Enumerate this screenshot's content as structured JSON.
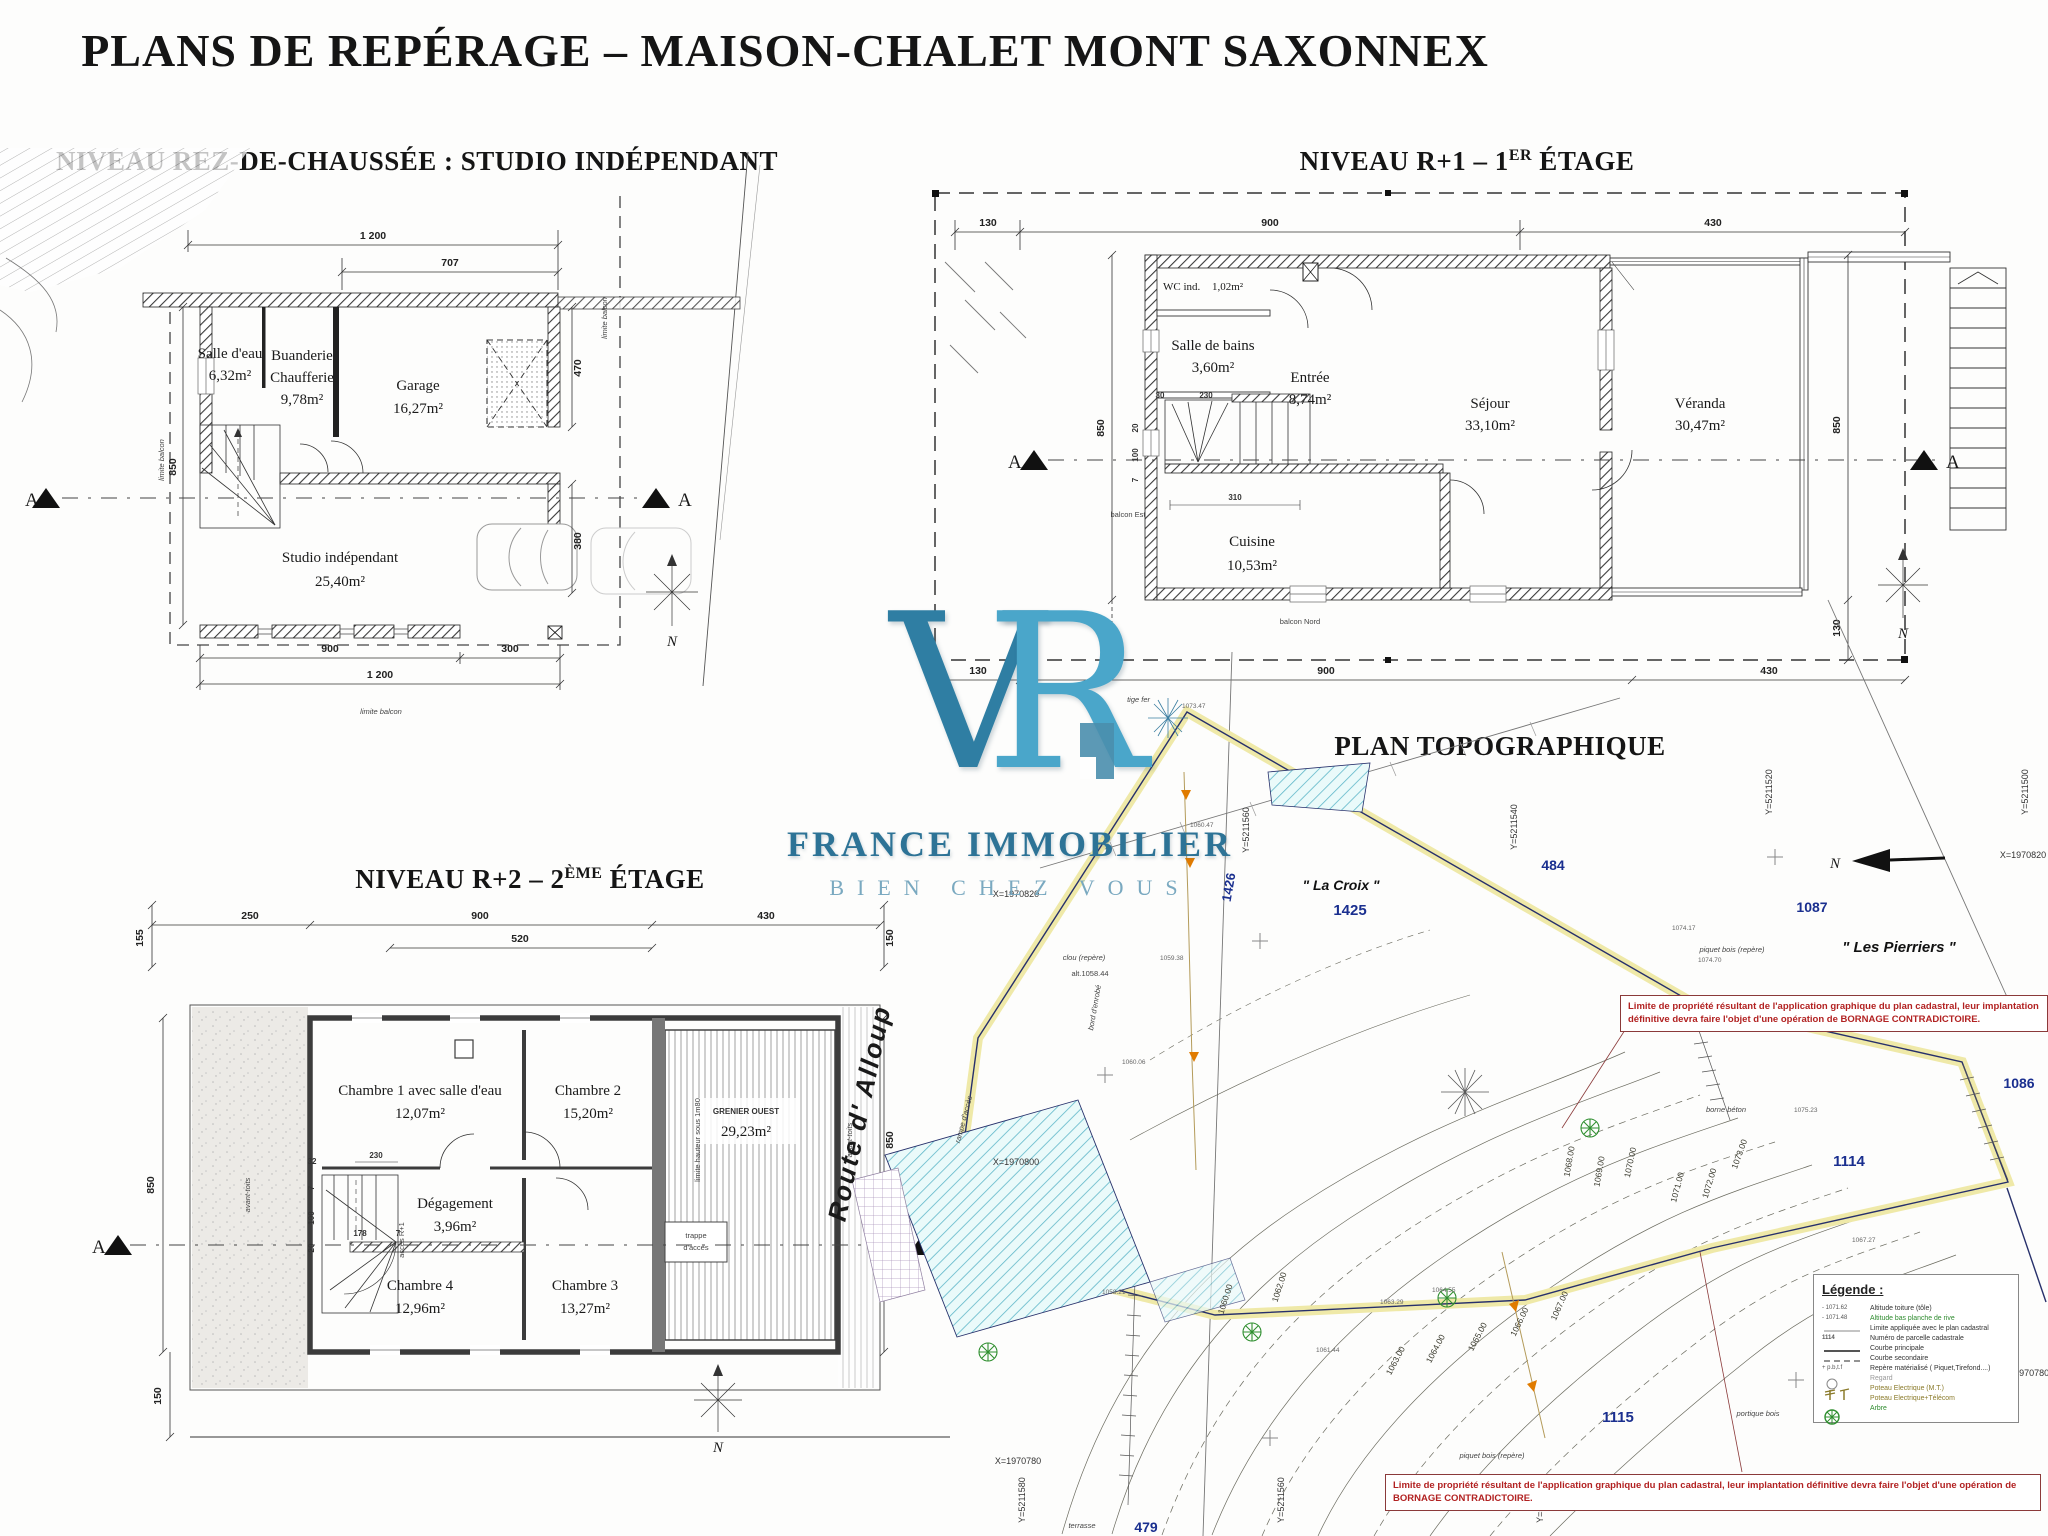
{
  "title": "PLANS DE REPÉRAGE – MAISON-CHALET MONT SAXONNEX",
  "logo": {
    "letter_v": "V",
    "letter_r": "R",
    "name": "FRANCE IMMOBILIER",
    "tagline": "BIEN CHEZ VOUS",
    "color_dark": "#2f7ea3",
    "color_light": "#4aa6ca"
  },
  "compass_label": "N",
  "section_label": "A",
  "plans": {
    "rdc": {
      "title": "NIVEAU REZ-DE-CHAUSSÉE : STUDIO INDÉPENDANT",
      "rooms": [
        {
          "name": "Salle d'eau",
          "area": "6,32m²"
        },
        {
          "name": "Buanderie",
          "name2": "Chaufferie",
          "area": "9,78m²"
        },
        {
          "name": "Garage",
          "area": "16,27m²"
        },
        {
          "name": "Studio indépendant",
          "area": "25,40m²"
        }
      ],
      "dims": [
        "1 200",
        "707",
        "470",
        "380",
        "850",
        "900",
        "300",
        "1 200"
      ],
      "limit_label": "limite balcon"
    },
    "r1": {
      "title_pre": "NIVEAU R+1 – 1",
      "title_sup": "ER",
      "title_post": " ÉTAGE",
      "rooms": [
        {
          "name": "WC ind.",
          "area": "1,02m²"
        },
        {
          "name": "Salle de bains",
          "area": "3,60m²"
        },
        {
          "name": "Entrée",
          "area": "8,74m²"
        },
        {
          "name": "Séjour",
          "area": "33,10m²"
        },
        {
          "name": "Véranda",
          "area": "30,47m²"
        },
        {
          "name": "Cuisine",
          "area": "10,53m²"
        }
      ],
      "dims_top": [
        "130",
        "900",
        "430"
      ],
      "dims_bottom": [
        "130",
        "900",
        "430"
      ],
      "dims_side": [
        "850",
        "850",
        "130",
        "130"
      ],
      "dims_inner": [
        "230",
        "30",
        "310",
        "20",
        "100",
        "7"
      ],
      "labels": {
        "balcon_est": "balcon Est",
        "balcon_nord": "balcon Nord"
      }
    },
    "r2": {
      "title_pre": "NIVEAU R+2 – 2",
      "title_sup": "ÈME",
      "title_post": " ÉTAGE",
      "rooms": [
        {
          "name": "Chambre 1 avec salle d'eau",
          "area": "12,07m²"
        },
        {
          "name": "Chambre 2",
          "area": "15,20m²"
        },
        {
          "name": "Dégagement",
          "area": "3,96m²"
        },
        {
          "name": "Chambre 4",
          "area": "12,96m²"
        },
        {
          "name": "Chambre 3",
          "area": "13,27m²"
        },
        {
          "name": "GRENIER OUEST",
          "area": "29,23m²"
        }
      ],
      "dims_top": [
        "155",
        "250",
        "900",
        "520",
        "430",
        "150"
      ],
      "dims_side": [
        "850",
        "850",
        "150"
      ],
      "dims_inner": [
        "32",
        "230",
        "7",
        "100",
        "20",
        "178",
        "7"
      ],
      "labels": {
        "eaves": "avant-toits",
        "eaves2": "avant-toits",
        "height_limit": "limite hauteur sous 1m80",
        "hatch_door": "trappe",
        "hatch_door2": "d'accès",
        "stair_access": "accès R+1"
      }
    },
    "topo": {
      "title": "PLAN TOPOGRAPHIQUE",
      "road": "Route d' Alloup",
      "places": [
        "\" La Croix \"",
        "\" Les Pierriers \""
      ],
      "parcels": [
        "1425",
        "1426",
        "484",
        "1087",
        "1086",
        "1114",
        "1115",
        "479"
      ],
      "grid_x": [
        "X=1970820",
        "X=1970800",
        "X=1970780",
        "X=1970820",
        "X=1970780"
      ],
      "grid_y": [
        "Y=5211560",
        "Y=5211540",
        "Y=5211520",
        "Y=5211500",
        "Y=5211580",
        "Y=5211560",
        "Y=5211540"
      ],
      "contours": [
        "1060.00",
        "1062.00",
        "1063.00",
        "1064.00",
        "1065.00",
        "1066.00",
        "1067.00",
        "1068.00",
        "1069.00",
        "1070.00",
        "1071.00",
        "1072.00",
        "1073.00"
      ],
      "spots": [
        "1060.47",
        "1059.38",
        "1060.06",
        "1063.29",
        "1064.55",
        "1061.44",
        "1073.47",
        "1074.17",
        "1074.70",
        "1075.23",
        "1058.21",
        "1067.27"
      ],
      "marks": {
        "tige_fer": "tige fer",
        "clou": "clou (repère)",
        "clou_alt": "alt.1058.44",
        "borne": "borne béton",
        "piquet": "piquet bois (repère)",
        "piquet2": "piquet bois (repère)",
        "rampe": "rampe d'accès",
        "enrobe": "bord d'enrobé",
        "terrasse": "terrasse",
        "portique": "portique bois"
      },
      "warning": "Limite de propriété résultant de l'application graphique du plan cadastral, leur implantation définitive devra faire l'objet d'une opération de BORNAGE CONTRADICTOIRE.",
      "legend": {
        "title": "Légende :",
        "entries": [
          {
            "key": "- 1071.62",
            "label": "Altitude toiture (tôle)"
          },
          {
            "key": "- 1071.48",
            "label": "Altitude bas planche de rive"
          },
          {
            "key": "",
            "label": "Limite appliquée avec le plan cadastral"
          },
          {
            "key": "1114",
            "label": "Numéro de parcelle cadastrale"
          },
          {
            "key": "",
            "label": "Courbe principale"
          },
          {
            "key": "",
            "label": "Courbe secondaire"
          },
          {
            "key": "+ p.b,t.f",
            "label": "Repère matérialisé ( Piquet,Tirefond....)"
          },
          {
            "key": "",
            "label": "Regard"
          },
          {
            "key": "",
            "label": "Poteau  Electrique (M.T.)"
          },
          {
            "key": "",
            "label": "Poteau  Electrique+Télécom"
          },
          {
            "key": "",
            "label": "Arbre"
          }
        ]
      }
    }
  }
}
